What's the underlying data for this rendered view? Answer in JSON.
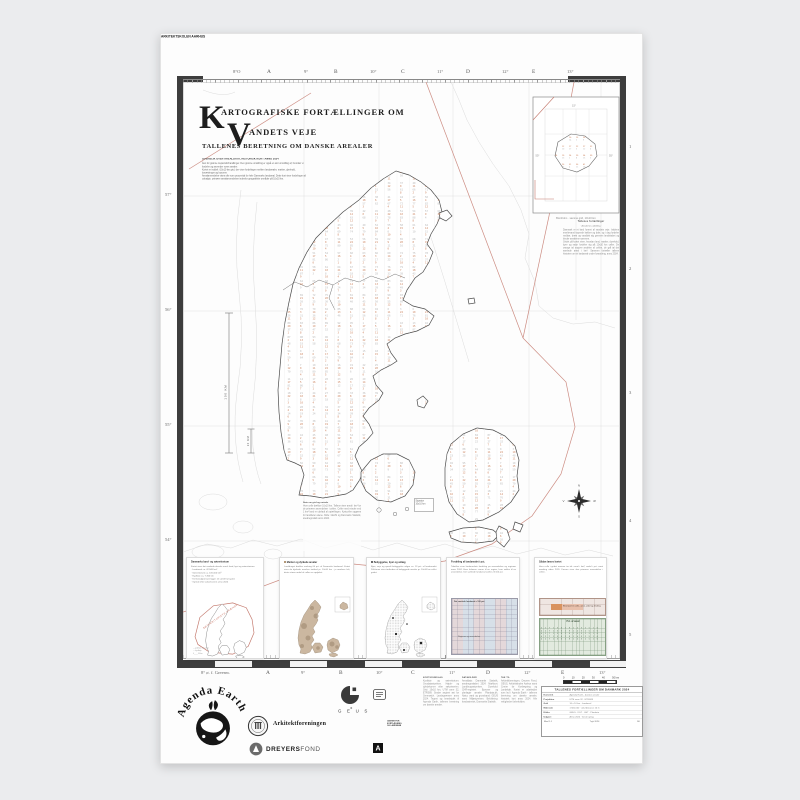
{
  "poster": {
    "title": {
      "drop1": "K",
      "rest1": "artografiske Fortællinger om",
      "drop2": "V",
      "rest2": "andets Veje"
    },
    "subtitle": "Tallenes Beretning om Danske Arealer",
    "tagline": "Overblik over arealdata, historisk kort anno 2024",
    "intro": [
      "Året for grønne trepartsforhandlinger. Den grønne omstilling er også en stor omstilling af, hvordan vi fordeler og anvender vores arealer.",
      "Kortet er inddelt i 10x10 km grid, der viser fordelingen mellem landarealer, marker, dyrehold, bosætninger og byzoner.",
      "Arealanvendelse vises ofte som procenttal for hele Danmarks landareal. Dette kort viser fordelingen af udvalgte, primære arealanvendelser indenfor geografiske områder på 10x10 km."
    ]
  },
  "frame": {
    "top_labels": [
      "8°O",
      "A",
      "9°",
      "B",
      "10°",
      "C",
      "11°",
      "D",
      "12°",
      "E",
      "13°"
    ],
    "bottom_labels": [
      "8° ø. f. Greenw.",
      "A",
      "9°",
      "B",
      "10°",
      "C",
      "11°",
      "D",
      "12°",
      "E",
      "13°"
    ],
    "left_labels": [
      "57°",
      "56°",
      "55°",
      "54°"
    ],
    "right_labels": [
      "1",
      "2",
      "3",
      "4",
      "5"
    ]
  },
  "map": {
    "scale_100": "100 KM",
    "scale_10": "10 KM",
    "compass_points": [
      "N",
      "Ø",
      "S",
      "V"
    ],
    "inset": {
      "deg_top": "15°",
      "deg_left": "55°",
      "deg_right": "55°",
      "caption": "Bornholm · samme grid, 10x10 km"
    },
    "right_col": {
      "heading": "Tallenes fortællinger",
      "sub": "· Arealernes udvikling ·",
      "paras": [
        "Danmark er et land formet af vandets veje. Istidens smeltevand tegnede bakker og dale, og i dag fordeler nedbør, dræn og vandløb sig gennem landskabet og binder arealerne sammen.",
        "Gridet på kortet viser, hvordan land, marker, dyrehold, byer og natur fordeler sig på 10x10 km celler. De orange tal angiver andelen af cellen, de grå tal det samlede areal i km². Sammen fortæller tallene historien om et landareal under forandring, anno 2024."
      ]
    },
    "mid_note": {
      "heading": "Note om grid og metode",
      "text": "Hver celle dækker 10x10 km. Tallene viser areal i km² for de primære anvendelser i cellen. Celler med mindre end 1 km² land er udeladt af optællingen. Kystceller opgøres for landdelen alene. Kilde: GEUS og Danmarks Statistik, arealregnskab anno 2024."
    },
    "note_box": {
      "l1": "Signatur",
      "l2": "10x10 km"
    }
  },
  "panels": [
    {
      "title": "Danmarks land- og søterritorium",
      "lines": [
        "Kortet viser det samlede danske areal: land, kyst og søterritorium.",
        "· Landareal ca. 42.940 km²",
        "· Søterritorium ca. 105.000 km²",
        "· Kystlinje ca. 7.300 km",
        "· Territorialgrænsen ligger 12 sømil fra kysten",
        "· Opmålt efter søkortserien anno 2024"
      ],
      "map_label": "SØTERRITORIETS GRÆNSE"
    },
    {
      "title": "Marker og dyrkede arealer",
      "body": "Landbruget dækker omkring 60 pct. af Danmarks landareal. Kortet viser de dyrkede arealers tæthed pr. 10x10 km - jo mørkere felt, desto større andel af cellen er opdyrket."
    },
    {
      "title": "Bebyggelse, byer og anlæg",
      "body": "Byer, veje og spredt bebyggelse udgør ca. 13 pct. af landarealet. Prikkerne viser tætheden af bebyggede arealer pr. 10x10 km celle i gridet."
    },
    {
      "title": "Fordeling af landarealet i pct.",
      "body": "Tabellen viser landarealets fordeling på anvendelser og regioner anno 2024. Hver kolonne svarer til en region, hver række til en anvendelse. Det samlede landareal sættes til 100 pct.",
      "table_label": "Det samlede landareal = 100 pct.",
      "table_sub": "Regioner og anvendelser"
    },
    {
      "title": "Sådan læses kortet",
      "body": "Hver celle i gridet rummer tre tal: areal i km², andel i pct. samt ændring siden 2011. Farven viser den primære anvendelse i cellen.",
      "hl_caption": "Eksempel: én celle - areal, andel og ændring",
      "grid_label": "Pct. af areal",
      "grid_digits": "4 2 7 1 3 6 2 8 1 4 3 2 5 1 6"
    }
  ],
  "footer": {
    "agenda_earth": "Agenda Earth",
    "arkitektforeningen": "Arkitektforeningen",
    "dreyers_bold": "DREYERS",
    "dreyers_light": "FOND",
    "geus": "G E U S",
    "center_lines": [
      "CENTER FOR",
      "KORTLÆGNING",
      "OG LANDSKAB"
    ],
    "aarhus": "ARKITEKTSKOLEN AARHUS",
    "credits_cols": [
      {
        "heading": "KORTGRUNDLAG",
        "body": "Kystlinje og søterritorium: Geodatastyrelsen. Højde- og dybdekurver efter søkortserien. Grid: 10x10 km, UTM zone 32, ETRS89. Grader angivet øst for Greenwich. Landegrænser anno 2024. Tegnet og bearbejdet til Agenda Earth, tallenes beretning om danske arealer."
      },
      {
        "heading": "DATAKILDER",
        "body": "Arealdata: Danmarks Statistik, arealregnskabet 2024. Markkort: Landbrugsstyrelsen. Dyrehold: CHR-registret. Byzoner og planlagte arealer: Plandata.dk. Natur, vand og grundvand: GEUS samt Miljøstyrelsen. Befolkning: kvadratnettet, Danmarks Statistik."
      },
      {
        "heading": "TAK TIL",
        "body": "Arkitektforeningen, Dreyers Fond, GEUS, Arkitektskolen Aarhus samt Center for Kortlægning og Landskab. Kortet er udarbejdet som led i Agenda Earth - tallenes beretning om danske arealer, historisk kort anno 2024. Alle rettigheder forbeholdes."
      }
    ],
    "scalebar_ticks": [
      "0",
      "10",
      "20",
      "30",
      "40",
      "50 km"
    ],
    "info_table": {
      "title": "TALLENES FORTÆLLINGER OM DANMARK 2024",
      "rows": [
        [
          "Kortværk",
          "Agenda Earth - danske arealer"
        ],
        [
          "Projektion",
          "UTM zone 32 · ETRS89"
        ],
        [
          "Grid",
          "10 x 10 km · landareal"
        ],
        [
          "Målestok",
          "1:500.000 · ækvidistance 10 m"
        ],
        [
          "Kilder",
          "GEUS · DST · GST · Plandata"
        ],
        [
          "Udgave",
          "Anno 2024 · første oplag"
        ]
      ],
      "footer_cells": [
        "Blad 1:1",
        "Tryk 2024",
        "DK"
      ]
    }
  },
  "colors": {
    "accent_red": "#c4796d",
    "number_orange": "#c97a52",
    "number_gray": "#b5b5b5",
    "frame_dark": "#3d3d3d",
    "tan": "#cbb7a0",
    "green_grid": "#e2eadf"
  }
}
